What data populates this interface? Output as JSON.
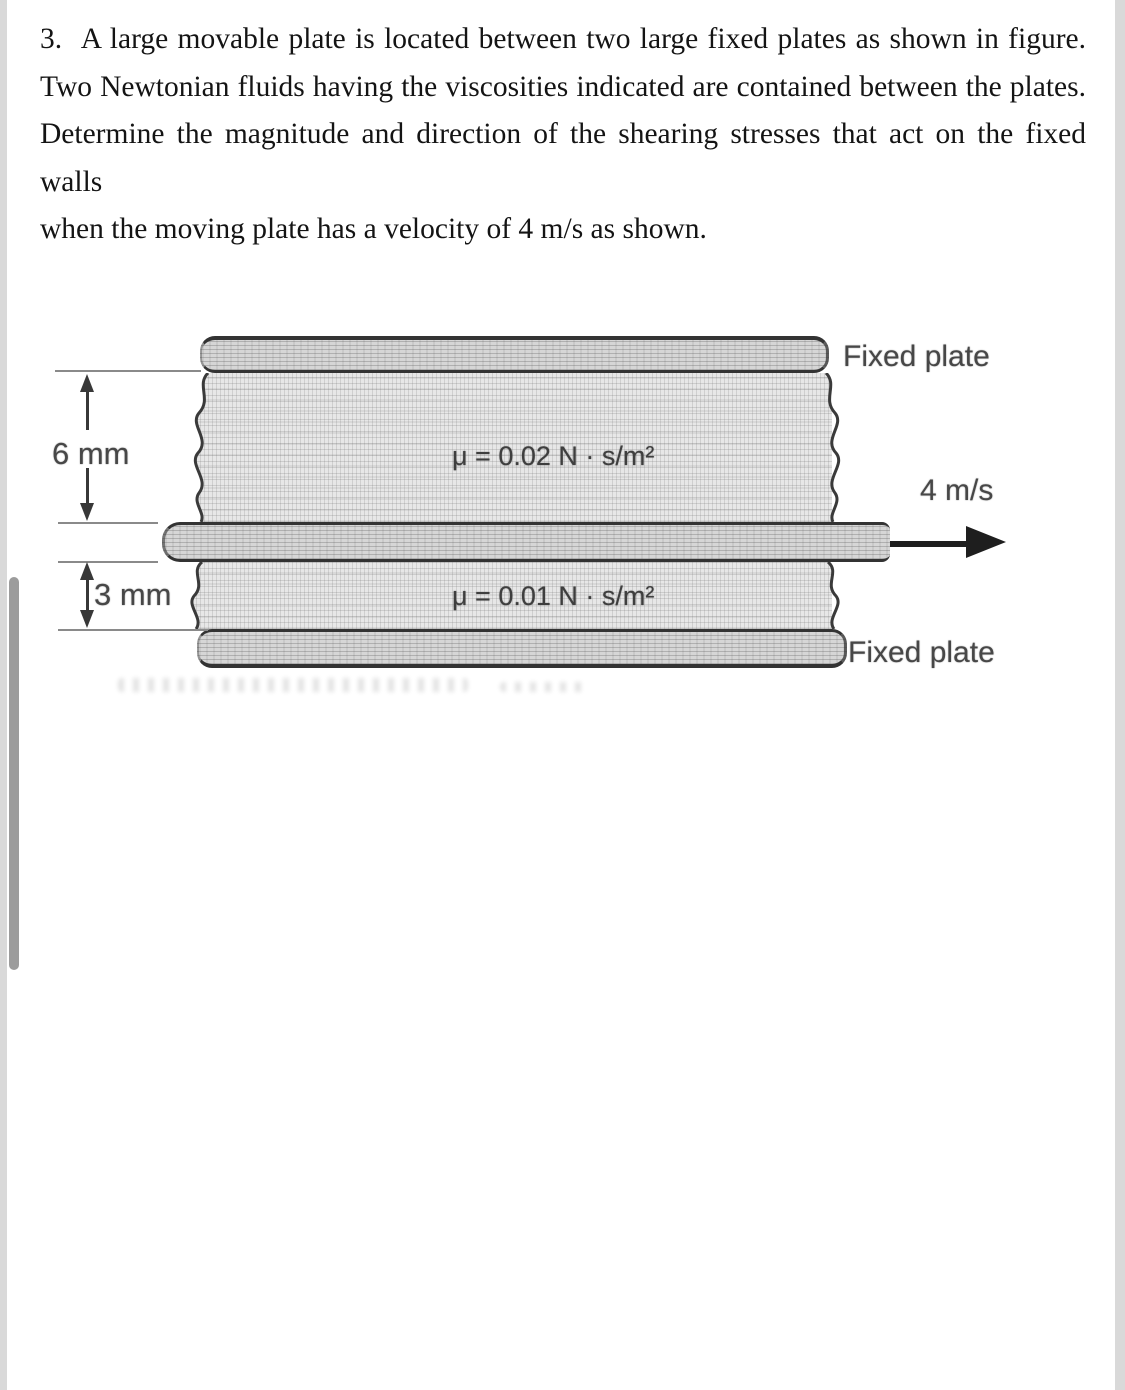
{
  "problem": {
    "lines": [
      "3.  A large movable plate is located between two large fixed plates as shown in figure.",
      "Two Newtonian fluids having the viscosities indicated are contained between the plates.",
      "Determine the magnitude and direction of the shearing stresses that act on the fixed walls",
      "when the moving plate has a velocity of 4 m/s as shown."
    ]
  },
  "figure": {
    "fixed_plate_top_label": "Fixed plate",
    "fixed_plate_bottom_label": "Fixed plate",
    "upper_fluid_viscosity": "μ = 0.02 N · s/m²",
    "lower_fluid_viscosity": "μ = 0.01 N · s/m²",
    "velocity_label": "4 m/s",
    "upper_gap_dimension": "6 mm",
    "lower_gap_dimension": "3 mm"
  },
  "icons": {
    "velocity_arrow": "right-arrow",
    "upper_dimension_arrows": "up-down-arrows",
    "lower_dimension_arrows": "up-down-arrows"
  },
  "colors": {
    "page_bg": "#ffffff",
    "edge_strip": "#d9d9d9",
    "scrollbar_thumb": "#9c9c9c",
    "body_text": "#141414",
    "figure_ink": "#383838",
    "figure_label": "#474747",
    "fluid_fill": "#e7e7e7",
    "plate_fill": "#d6d6d6"
  }
}
